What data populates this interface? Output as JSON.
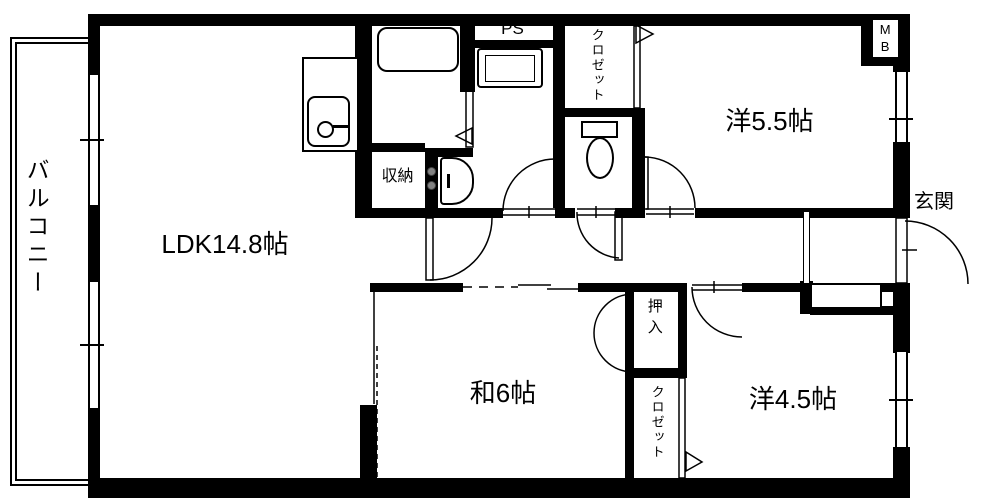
{
  "plan": {
    "balcony": "バルコニー",
    "ldk": "LDK14.8帖",
    "japanese_room": "和6帖",
    "western_room_large": "洋5.5帖",
    "western_room_small": "洋4.5帖",
    "entrance": "玄関",
    "closet_upper": "クロゼット",
    "closet_lower": "クロゼット",
    "oshiire": "押入",
    "storage": "収納",
    "pipe_space": "PS",
    "meter_box": "MB"
  },
  "colors": {
    "wall": "#000000",
    "background": "#ffffff",
    "line": "#000000",
    "door_knob": "#808080"
  },
  "fixtures": [
    "bathtub",
    "kitchen-sink",
    "washing-machine-pan",
    "toilet",
    "washbasin",
    "shoe-cabinet"
  ]
}
